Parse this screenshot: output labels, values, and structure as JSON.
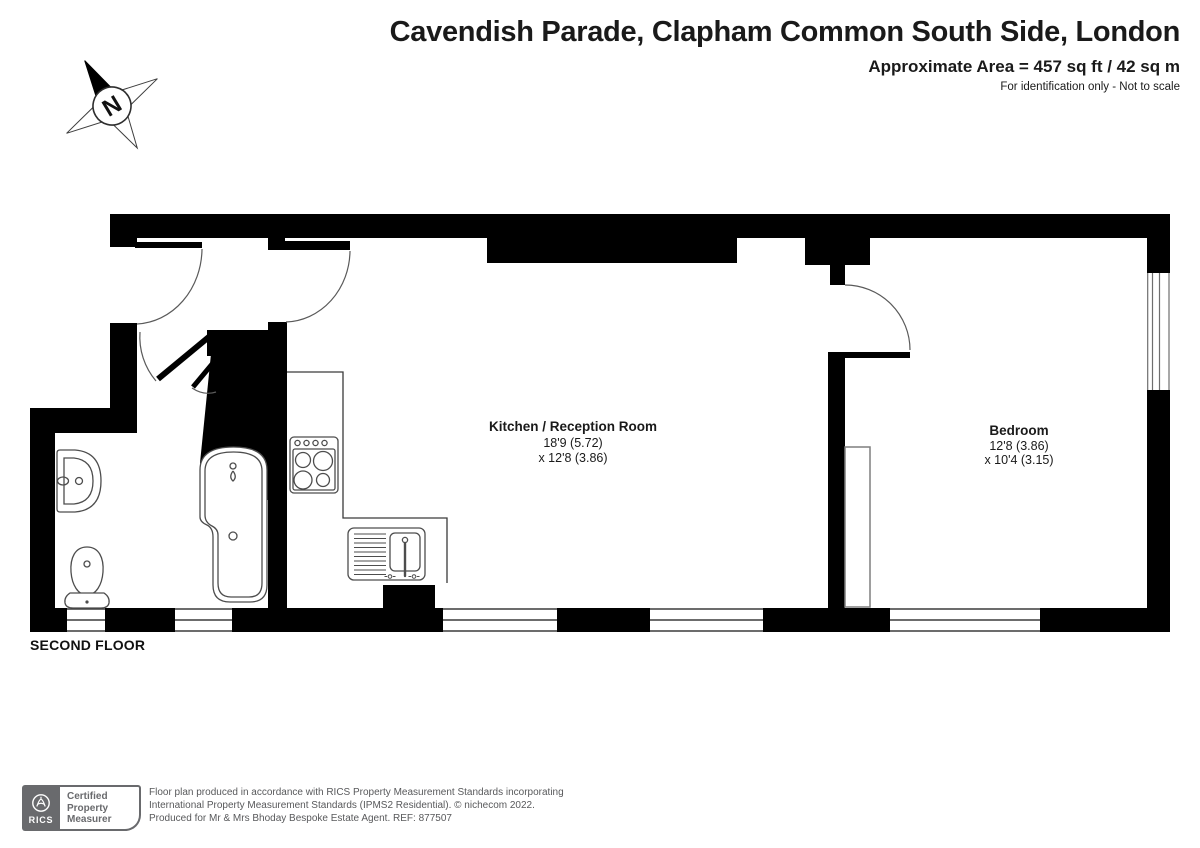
{
  "header": {
    "title": "Cavendish Parade, Clapham Common South Side, London",
    "area": "Approximate Area = 457 sq ft / 42 sq m",
    "disclaimer": "For identification only - Not to scale"
  },
  "compass": {
    "north_label": "N"
  },
  "floor": {
    "label": "SECOND FLOOR"
  },
  "rooms": {
    "kitchen": {
      "name": "Kitchen / Reception Room",
      "dim_line1": "18'9 (5.72)",
      "dim_line2": "x 12'8 (3.86)"
    },
    "bedroom": {
      "name": "Bedroom",
      "dim_line1": "12'8 (3.86)",
      "dim_line2": "x 10'4 (3.15)"
    }
  },
  "footer": {
    "rics_label": "RICS",
    "badge_line1": "Certified",
    "badge_line2": "Property",
    "badge_line3": "Measurer",
    "text_line1": "Floor plan produced in accordance with RICS Property Measurement Standards incorporating",
    "text_line2": "International Property Measurement Standards (IPMS2 Residential).   © nichecom 2022.",
    "text_line3": "Produced for Mr & Mrs Bhoday Bespoke Estate Agent.   REF: 877507"
  },
  "colors": {
    "wall": "#000000",
    "fixture_line": "#4d4d4d",
    "footer_text": "#58595b",
    "badge_gray": "#696a6d"
  }
}
